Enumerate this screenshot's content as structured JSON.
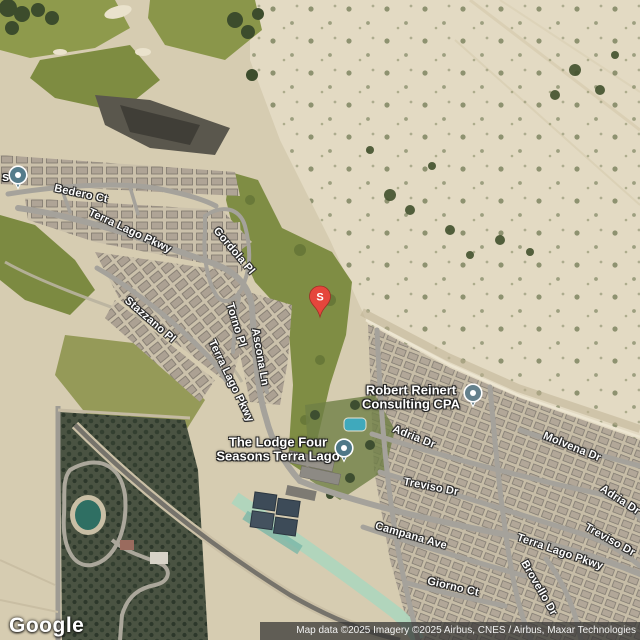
{
  "google_logo": "Google",
  "attribution": "Map data ©2025 Imagery ©2025 Airbus, CNES / Airbus, Maxar Technologies",
  "markers": {
    "s_label": "S",
    "s_color": "#E5463C",
    "cpa_pin_color": "#64808C",
    "lodge_pin_color": "#4E7887",
    "edge_pin_color": "#557C8B",
    "partial_place_label": "s"
  },
  "places": {
    "cpa": {
      "line1": "Robert Reinert",
      "line2": "Consulting CPA"
    },
    "lodge": {
      "line1": "The Lodge Four",
      "line2": "Seasons Terra Lago"
    }
  },
  "streets": [
    {
      "name": "Bedero Ct"
    },
    {
      "name": "Terra Lago Pkwy"
    },
    {
      "name": "Gordola Pl"
    },
    {
      "name": "Stazzano Pl"
    },
    {
      "name": "Torno Pl"
    },
    {
      "name": "Terra Lago Pkwy"
    },
    {
      "name": "Ascona Ln"
    },
    {
      "name": "Adria Dr"
    },
    {
      "name": "Molvena Dr"
    },
    {
      "name": "Treviso Dr"
    },
    {
      "name": "Campana Ave"
    },
    {
      "name": "Giorno Ct"
    },
    {
      "name": "Terra Lago Pkwy"
    },
    {
      "name": "Brovello Dr"
    },
    {
      "name": "Treviso Dr"
    },
    {
      "name": "Adria Dr"
    }
  ]
}
